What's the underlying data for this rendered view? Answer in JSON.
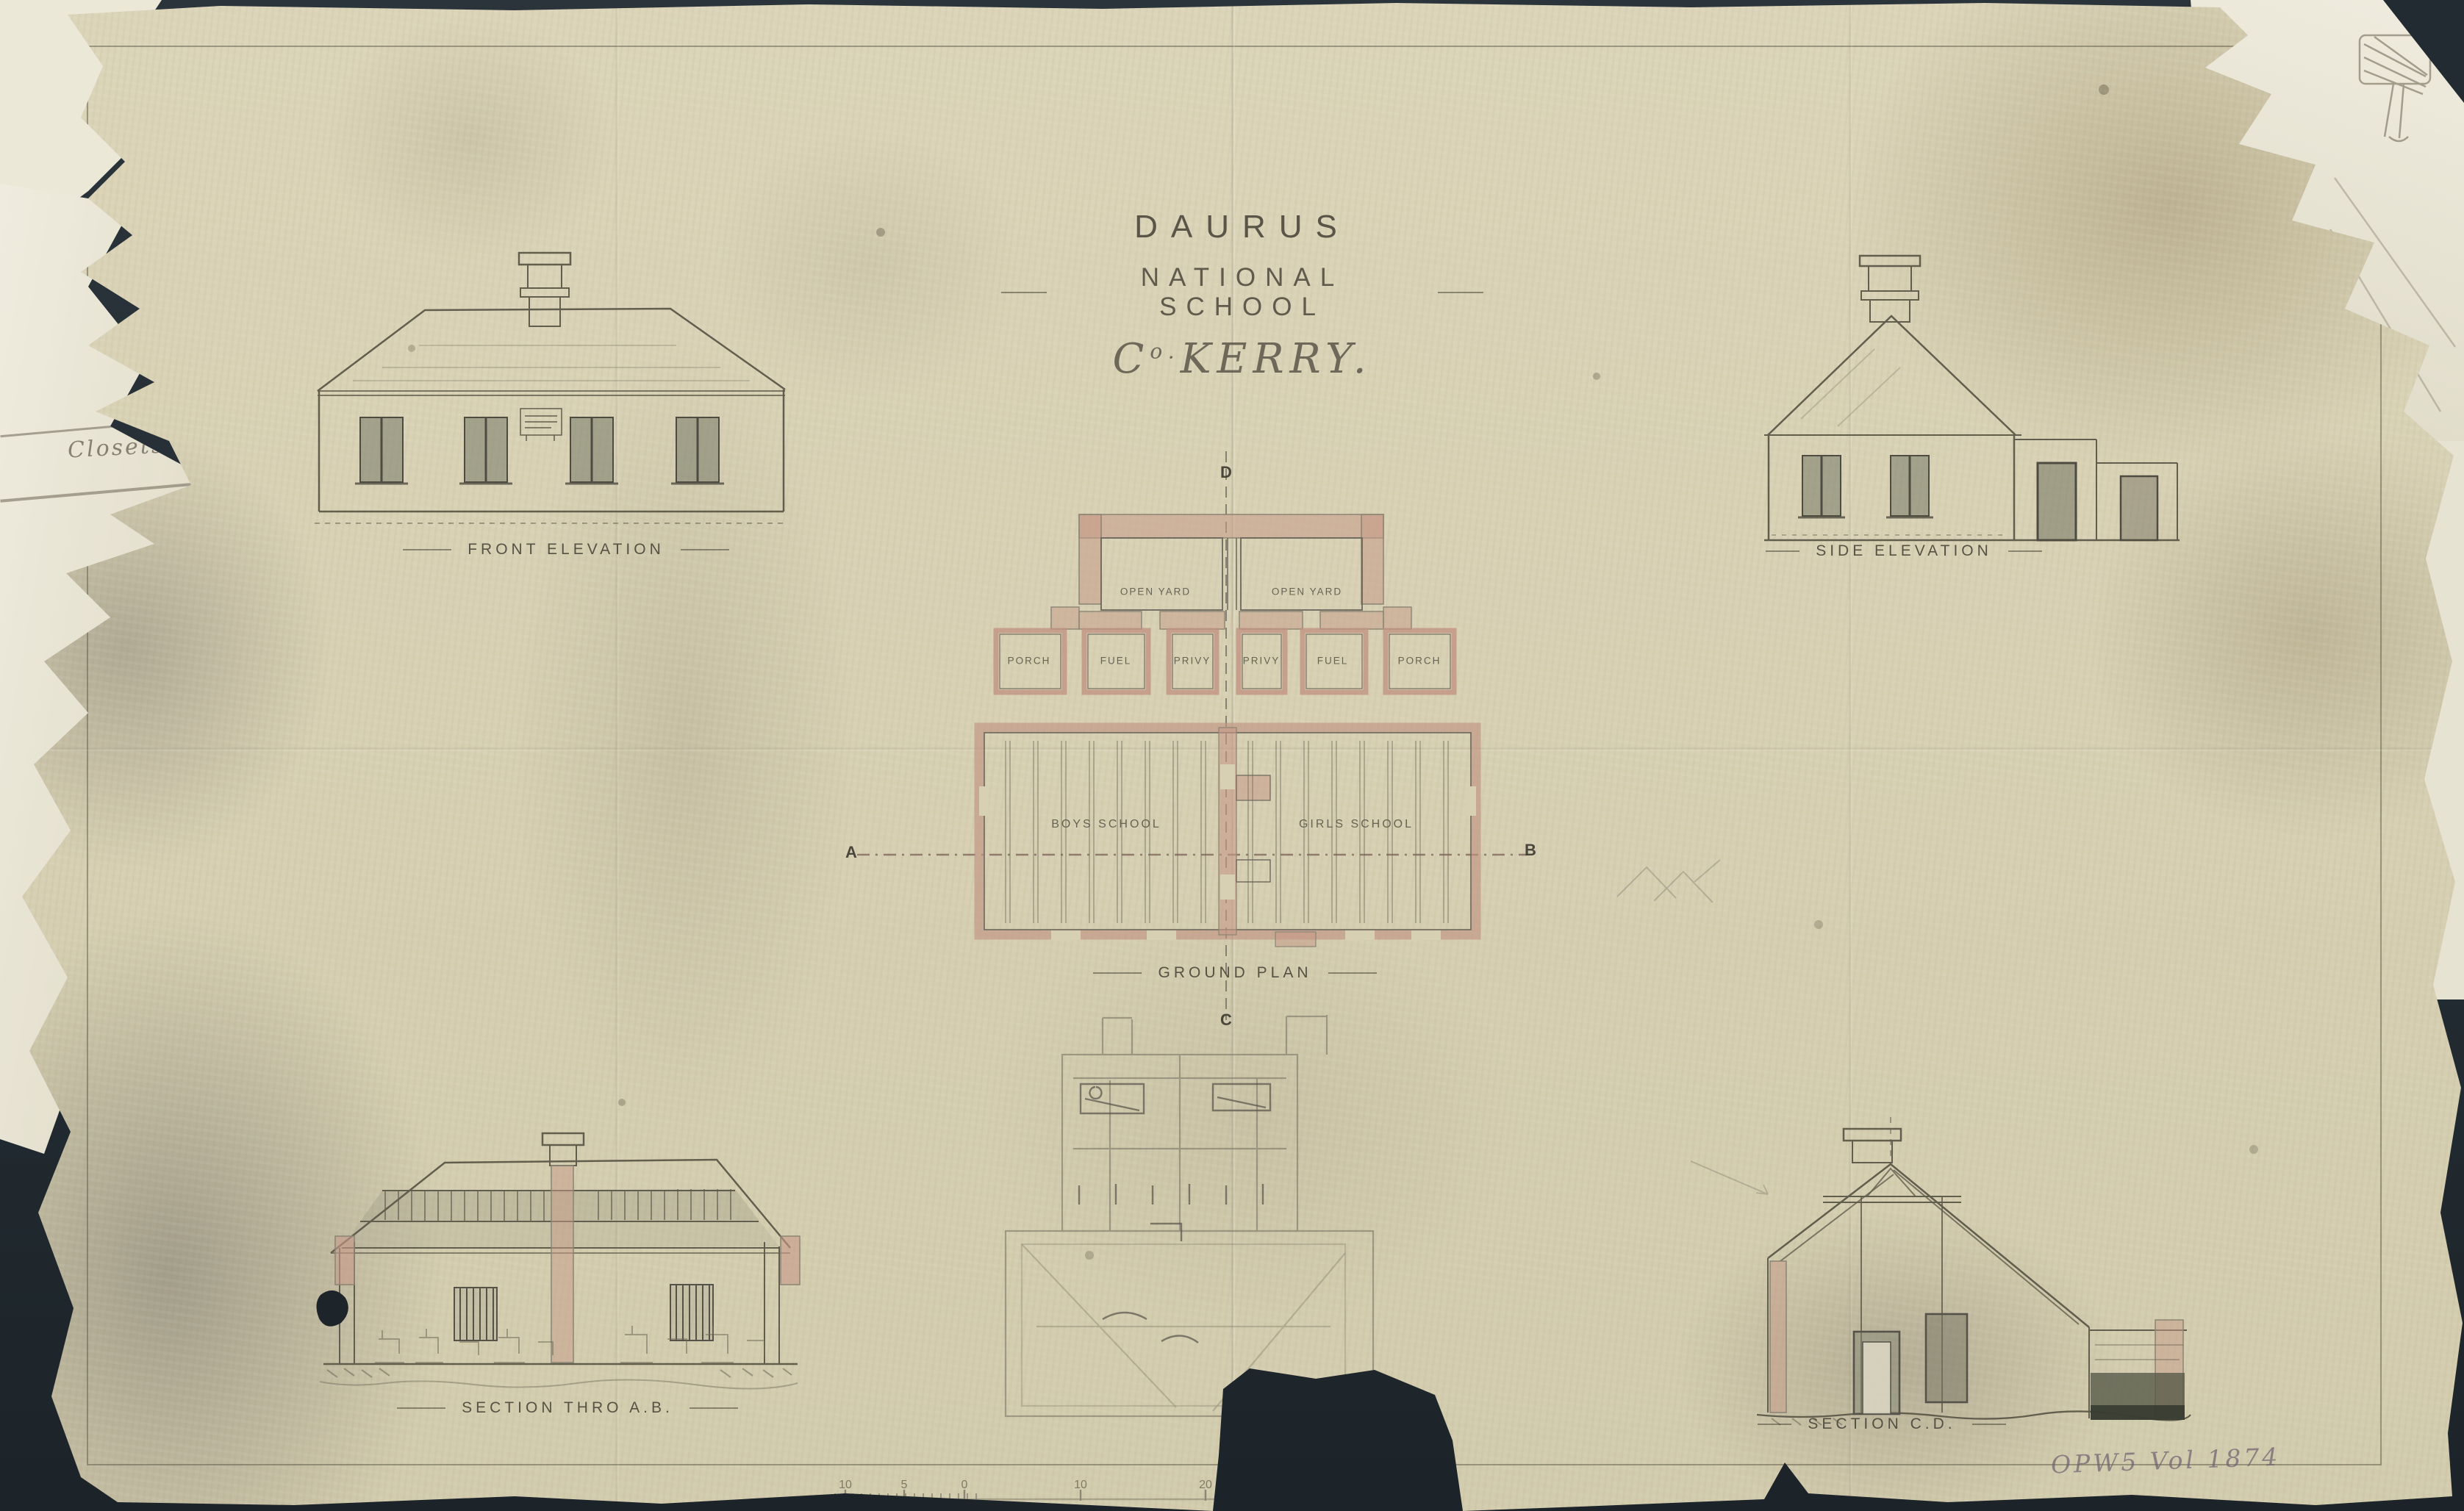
{
  "document": {
    "title": {
      "line1": "DAURUS",
      "line2": "NATIONAL SCHOOL",
      "county_c": "C",
      "county_o": "o.",
      "county_rest": "KERRY."
    },
    "drawings": {
      "front_elevation": {
        "caption": "FRONT ELEVATION"
      },
      "side_elevation": {
        "caption": "SIDE ELEVATION"
      },
      "ground_plan": {
        "caption": "GROUND PLAN",
        "open_yard_left": "OPEN YARD",
        "open_yard_right": "OPEN YARD",
        "rooms": [
          "PORCH",
          "FUEL",
          "PRIVY",
          "PRIVY",
          "FUEL",
          "PORCH"
        ],
        "boys_school": "BOYS SCHOOL",
        "girls_school": "GIRLS SCHOOL",
        "marker_a": "A",
        "marker_b": "B",
        "marker_c": "C",
        "marker_d": "D"
      },
      "section_ab": {
        "caption": "SECTION THRO A.B."
      },
      "section_cd": {
        "caption": "SECTION C.D."
      }
    },
    "annotations": {
      "closets": "Closets",
      "archive_ref": "OPW5 Vol 1874"
    },
    "scale_bar": {
      "numbers": [
        "10",
        "5",
        "0",
        "10",
        "20"
      ]
    },
    "colors": {
      "paper": "#d8d1b4",
      "backdrop": "#242e36",
      "wall_pink": "#c69a88",
      "pencil": "#5f5b4d"
    }
  }
}
